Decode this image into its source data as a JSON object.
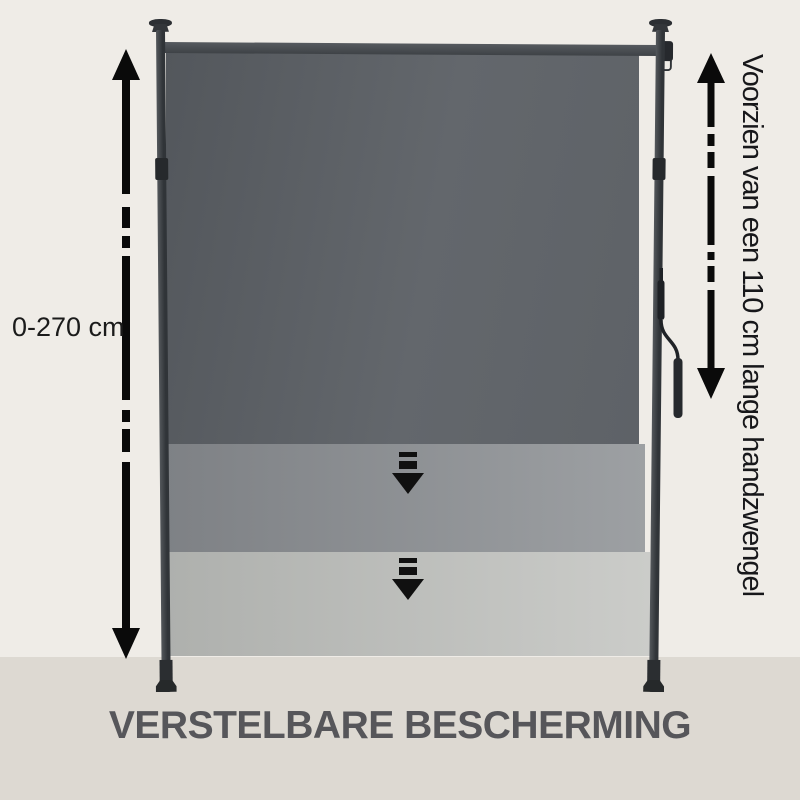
{
  "labels": {
    "range": "0-270 cm",
    "crank_note": "Voorzien van een 110 cm lange handzwengel",
    "title": "VERSTELBARE BESCHERMING"
  },
  "icons": {
    "left_dimension_arrow": "vertical-dashed-double-headed-arrow",
    "right_dimension_arrow": "vertical-dashed-double-headed-arrow",
    "extend_arrow": "double-bar-down-arrow"
  },
  "colors": {
    "background": "#efece7",
    "floor": "#ddd9d2",
    "fabric_dark": "#5e6267",
    "fabric_medium": "#8f9296",
    "fabric_light": "#bcbeba",
    "frame_metal": "#2c2f33",
    "roller_tube": "#4a4e53",
    "annotation_black": "#0a0a0a",
    "title_text": "#56565a"
  }
}
